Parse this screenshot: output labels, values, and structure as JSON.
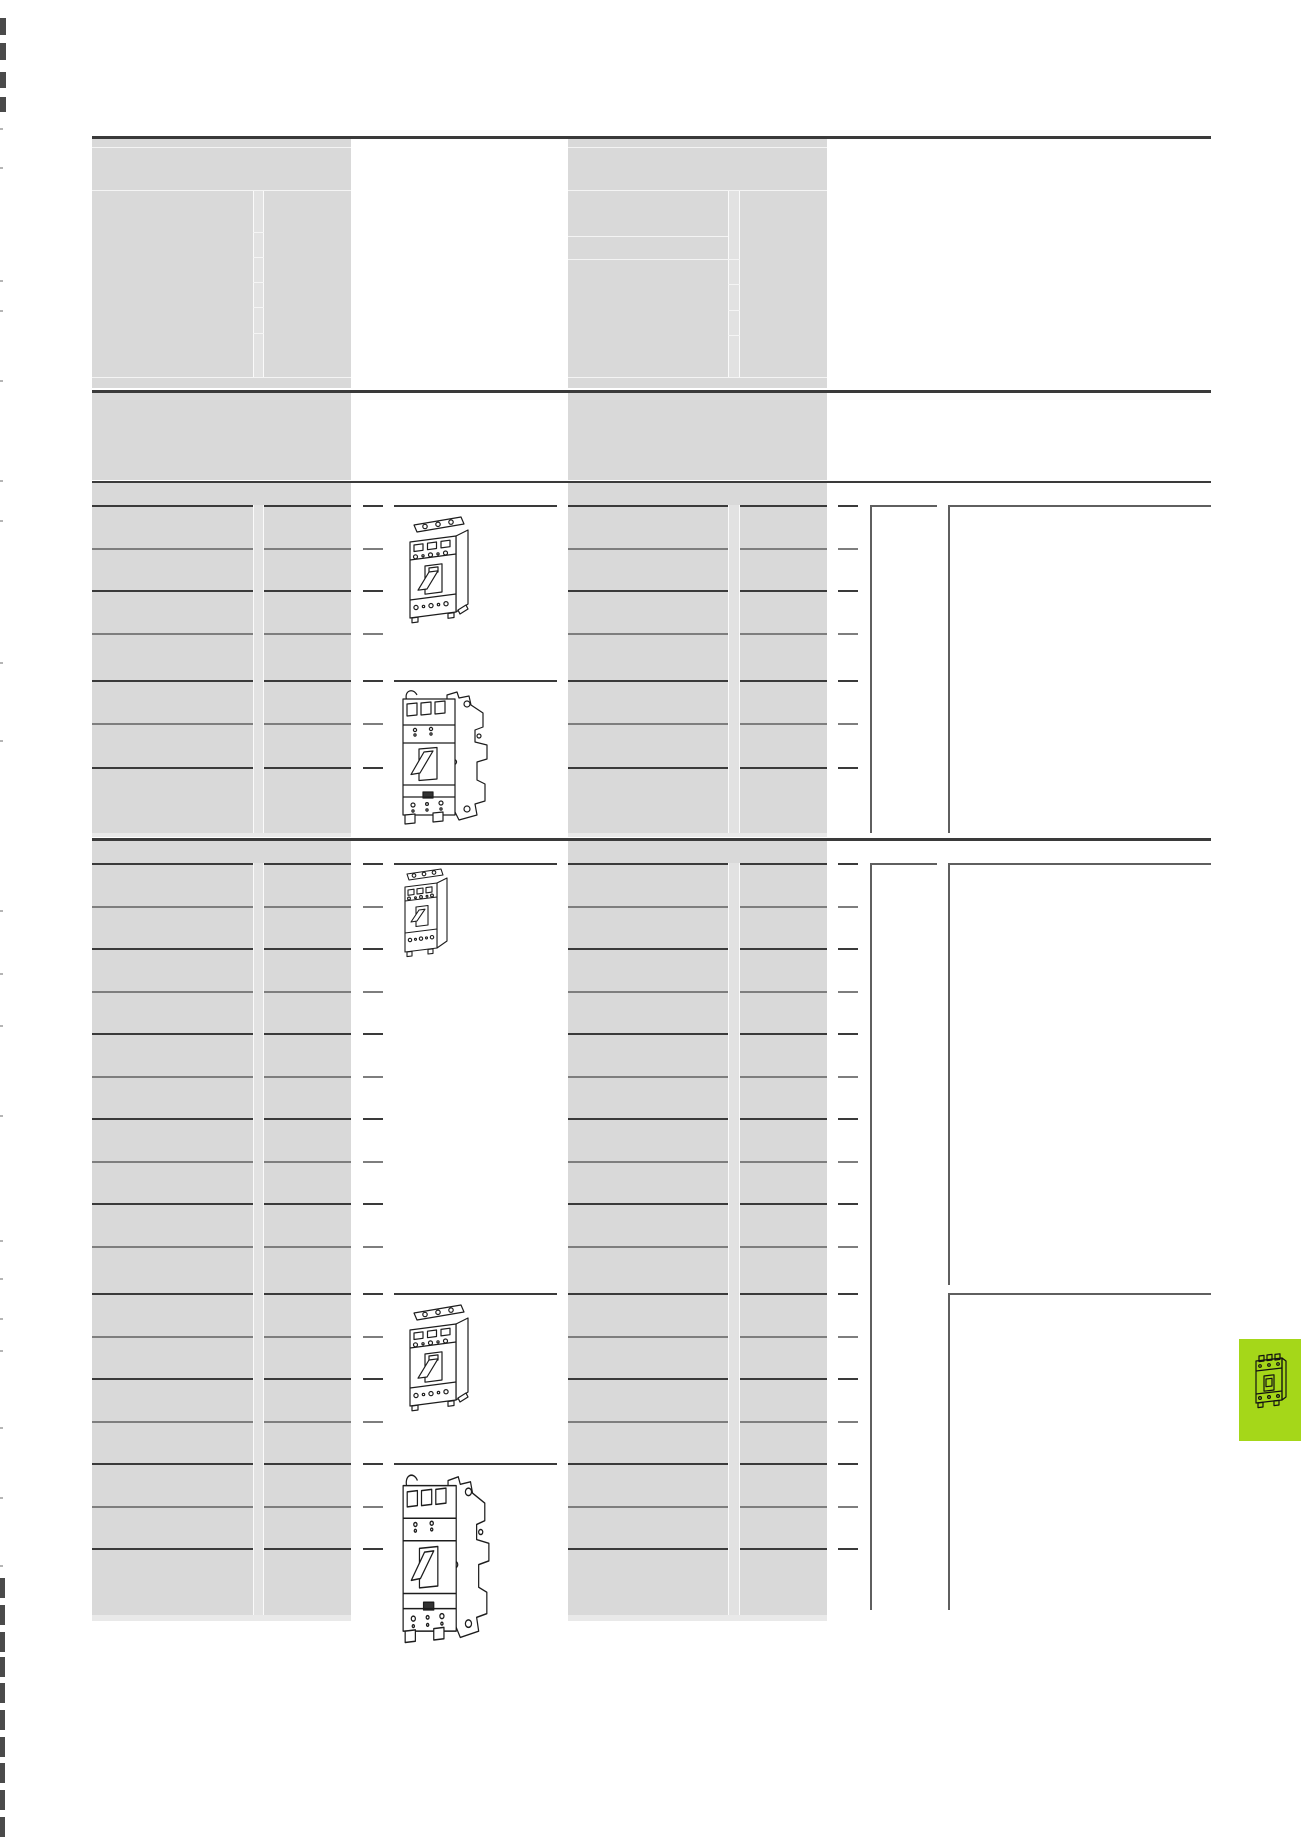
{
  "page": {
    "width": 1301,
    "height": 1839,
    "background": "#ffffff"
  },
  "colors": {
    "redaction": "#d9d9d9",
    "redaction_light": "#e2e2e2",
    "hairline": "#f4f4f4",
    "fade": "#e9e9e9",
    "rule": "#3a3a3a",
    "row_line_dark": "#3a3a3a",
    "row_line_light": "#7e7e7e",
    "bracket_line": "#5f5f5f",
    "mark_dark": "#4a4a4a",
    "mark_faint": "#b5b5b5",
    "accent_green": "#a5d719",
    "drawing_stroke": "#1d1d1d"
  },
  "layout": {
    "content_x": 92,
    "content_right": 1211,
    "row_segments": [
      [
        92,
        253
      ],
      [
        264,
        351
      ],
      [
        363,
        383
      ],
      [
        568,
        728
      ],
      [
        740,
        827
      ],
      [
        838,
        858
      ]
    ],
    "drawing_row_extra_segment": [
      394,
      557
    ],
    "col3_x": 870,
    "col3_top_w": 67,
    "col4_x": 948
  },
  "rules": [
    {
      "name": "top-rule",
      "y": 136,
      "h": 3
    },
    {
      "name": "spec-header-bottom-rule",
      "y": 390,
      "h": 3
    },
    {
      "name": "equipment-note-bottom-rule",
      "y": 481,
      "h": 2
    },
    {
      "name": "section1-bottom-rule",
      "y": 838,
      "h": 3
    }
  ],
  "redaction_blocks": [
    {
      "name": "spec-header-redacted-left",
      "x": 92,
      "y": 139,
      "w": 259,
      "h": 249
    },
    {
      "name": "spec-header-redacted-right",
      "x": 568,
      "y": 139,
      "w": 259,
      "h": 249
    },
    {
      "name": "equipment-note-redacted-left",
      "x": 92,
      "y": 393,
      "w": 259,
      "h": 87
    },
    {
      "name": "equipment-note-redacted-right",
      "x": 568,
      "y": 393,
      "w": 259,
      "h": 87
    },
    {
      "name": "section1-title-redacted-left",
      "x": 92,
      "y": 483,
      "w": 259,
      "h": 22
    },
    {
      "name": "section1-title-redacted-right",
      "x": 568,
      "y": 483,
      "w": 259,
      "h": 22
    },
    {
      "name": "section1-rows-redacted-left",
      "x": 92,
      "y": 505,
      "w": 259,
      "h": 328
    },
    {
      "name": "section1-rows-redacted-right",
      "x": 568,
      "y": 505,
      "w": 259,
      "h": 328
    },
    {
      "name": "section2-title-redacted-left",
      "x": 92,
      "y": 841,
      "w": 259,
      "h": 22
    },
    {
      "name": "section2-title-redacted-right",
      "x": 568,
      "y": 841,
      "w": 259,
      "h": 22
    },
    {
      "name": "section2-rows-redacted-left",
      "x": 92,
      "y": 863,
      "w": 259,
      "h": 752
    },
    {
      "name": "section2-rows-redacted-right",
      "x": 568,
      "y": 863,
      "w": 259,
      "h": 752
    }
  ],
  "fade_strips": [
    {
      "name": "section1-grey-fade-left",
      "x": 92,
      "y": 833,
      "w": 259,
      "h": 4
    },
    {
      "name": "section1-grey-fade-right",
      "x": 568,
      "y": 833,
      "w": 259,
      "h": 4
    },
    {
      "name": "section2-grey-fade-left",
      "x": 92,
      "y": 1615,
      "w": 259,
      "h": 6
    },
    {
      "name": "section2-grey-fade-right",
      "x": 568,
      "y": 1615,
      "w": 259,
      "h": 6
    }
  ],
  "gutter_strips": [
    {
      "name": "spec-header-gutter-left",
      "x": 253,
      "w": 11,
      "y1": 190,
      "y2": 377
    },
    {
      "name": "spec-header-gutter-right",
      "x": 728,
      "w": 12,
      "y1": 190,
      "y2": 377
    },
    {
      "name": "section1-gutter-left",
      "x": 253,
      "w": 11,
      "y1": 505,
      "y2": 833
    },
    {
      "name": "section1-gutter-right",
      "x": 728,
      "w": 12,
      "y1": 505,
      "y2": 833
    },
    {
      "name": "section2-gutter-left",
      "x": 253,
      "w": 11,
      "y1": 863,
      "y2": 1615
    },
    {
      "name": "section2-gutter-right",
      "x": 728,
      "w": 12,
      "y1": 863,
      "y2": 1615
    }
  ],
  "header_hairlines": {
    "horizontal_left": [
      147,
      190,
      377
    ],
    "horizontal_right": [
      147,
      190,
      377
    ],
    "right_extra": [
      {
        "y": 236,
        "x1": 568,
        "x2": 728
      },
      {
        "y": 259,
        "x1": 568,
        "x2": 740
      }
    ],
    "gutter_cells_left": [
      232,
      257,
      282,
      307,
      333
    ],
    "gutter_cells_right": [
      284,
      310,
      335
    ]
  },
  "sections": [
    {
      "name": "section-1",
      "rows_y": [
        505,
        548,
        590,
        633,
        680,
        723,
        767
      ],
      "drawing_rows": [
        505,
        680
      ],
      "bracket": {
        "col3": [
          505,
          833
        ],
        "col4": [
          [
            505,
            833
          ]
        ]
      }
    },
    {
      "name": "section-2",
      "rows_y": [
        863,
        906,
        948,
        991,
        1033,
        1076,
        1118,
        1161,
        1203,
        1246,
        1293,
        1336,
        1378,
        1421,
        1463,
        1506,
        1548
      ],
      "drawing_rows": [
        863,
        1293,
        1463
      ],
      "bracket": {
        "col3": [
          863,
          1610
        ],
        "col4": [
          [
            863,
            1285
          ],
          [
            1293,
            1610
          ]
        ]
      }
    }
  ],
  "drawings": [
    {
      "name": "circuit-breaker-fixed-mounting-drawing-1",
      "type": "fixed",
      "x": 402,
      "y": 510,
      "w": 72,
      "h": 116
    },
    {
      "name": "circuit-breaker-plug-in-base-drawing-1",
      "type": "din",
      "x": 397,
      "y": 685,
      "w": 96,
      "h": 145
    },
    {
      "name": "circuit-breaker-compact-drawing",
      "type": "small",
      "x": 400,
      "y": 865,
      "w": 52,
      "h": 98
    },
    {
      "name": "circuit-breaker-fixed-mounting-drawing-2",
      "type": "fixed",
      "x": 402,
      "y": 1298,
      "w": 72,
      "h": 116
    },
    {
      "name": "circuit-breaker-plug-in-base-drawing-2",
      "type": "din",
      "x": 397,
      "y": 1468,
      "w": 98,
      "h": 182
    }
  ],
  "green_tab": {
    "x": 1239,
    "y": 1339,
    "w": 62,
    "h": 102
  },
  "print_marks": {
    "top_bars": [
      {
        "y": 18,
        "h": 17
      },
      {
        "y": 43,
        "h": 17
      },
      {
        "y": 72,
        "h": 16
      },
      {
        "y": 97,
        "h": 15
      }
    ],
    "faint_ticks_y": [
      128,
      167,
      280,
      310,
      380,
      480,
      520,
      662,
      740,
      910,
      973,
      1025,
      1115,
      1240,
      1278,
      1318,
      1350,
      1427,
      1497,
      1565
    ],
    "bottom_bars_y": [
      1578,
      1605,
      1632,
      1657,
      1683,
      1710,
      1737,
      1763,
      1790,
      1817
    ]
  }
}
